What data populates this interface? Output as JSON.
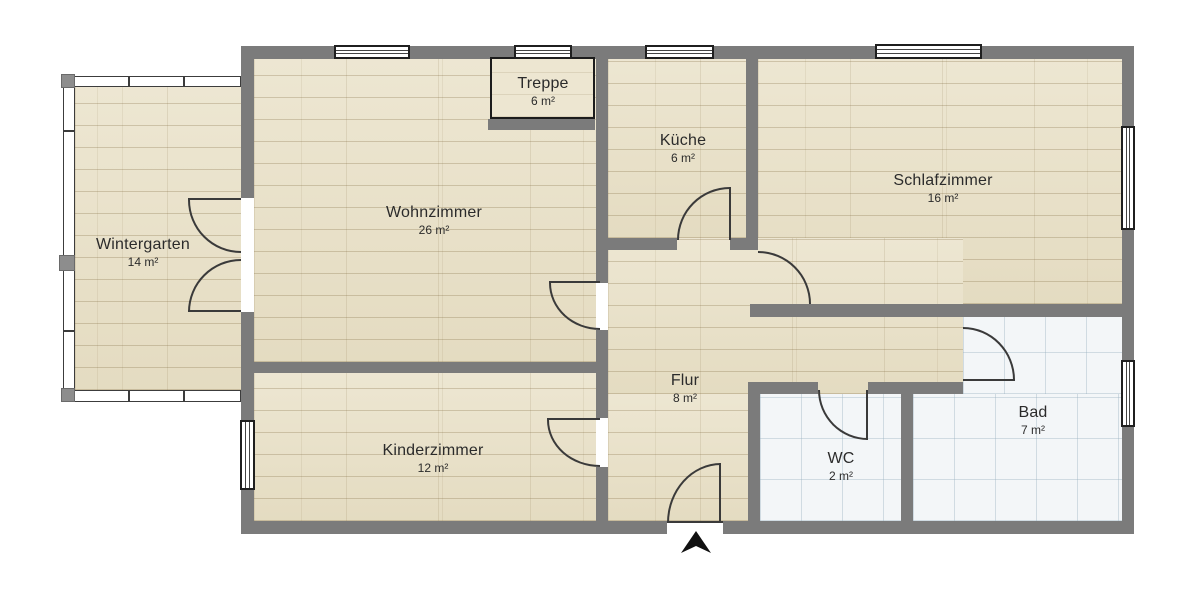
{
  "plan_type": "floor-plan",
  "rooms": {
    "wintergarten": {
      "name": "Wintergarten",
      "area": "14 m²"
    },
    "wohnzimmer": {
      "name": "Wohnzimmer",
      "area": "26 m²"
    },
    "treppe": {
      "name": "Treppe",
      "area": "6 m²"
    },
    "kueche": {
      "name": "Küche",
      "area": "6 m²"
    },
    "schlafzimmer": {
      "name": "Schlafzimmer",
      "area": "16 m²"
    },
    "flur": {
      "name": "Flur",
      "area": "8 m²"
    },
    "kinderzimmer": {
      "name": "Kinderzimmer",
      "area": "12 m²"
    },
    "wc": {
      "name": "WC",
      "area": "2 m²"
    },
    "bad": {
      "name": "Bad",
      "area": "7 m²"
    }
  },
  "icons": {
    "entrance_marker": "arrow-up-icon"
  },
  "colors": {
    "wall": "#7b7b7b",
    "wood": "#e9e1c8",
    "tile": "#f3f6f8",
    "line": "#3a3a3a",
    "text": "#2b2b2b",
    "win": "#ffffff",
    "bg": "#ffffff"
  }
}
